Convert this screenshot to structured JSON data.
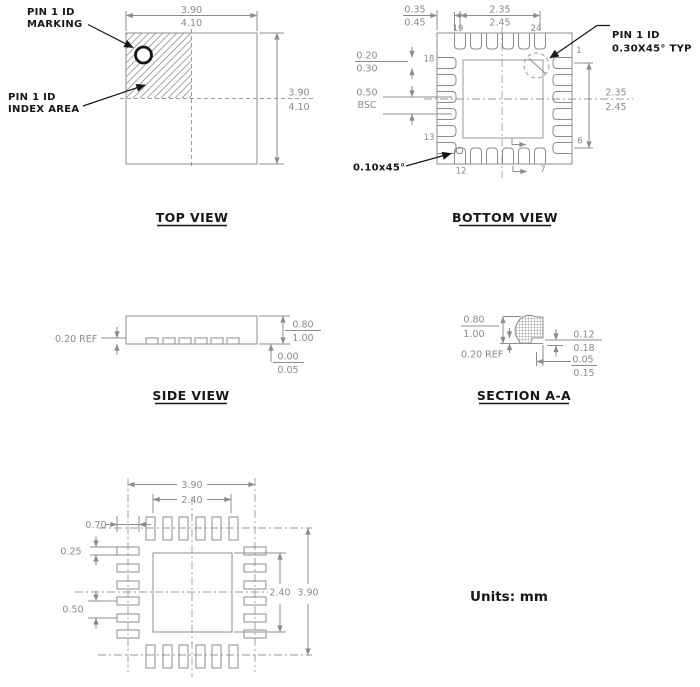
{
  "units_label": "Units: mm",
  "top_view": {
    "title": "TOP VIEW",
    "pin1_marking_label": {
      "line1": "PIN 1 ID",
      "line2": "MARKING"
    },
    "pin1_index_label": {
      "line1": "PIN 1 ID",
      "line2": "INDEX AREA"
    },
    "dim_body_width": {
      "min": "3.90",
      "max": "4.10"
    },
    "dim_body_height": {
      "min": "3.90",
      "max": "4.10"
    }
  },
  "bottom_view": {
    "title": "BOTTOM VIEW",
    "pin1_id_label": {
      "line1": "PIN 1 ID",
      "line2": "0.30X45° TYP"
    },
    "corner_chamfer_label": "0.10x45°",
    "dim_corner": {
      "min": "0.35",
      "max": "0.45"
    },
    "dim_pad_span_top": {
      "min": "2.35",
      "max": "2.45"
    },
    "dim_pad_width": {
      "min": "0.20",
      "max": "0.30"
    },
    "dim_pitch": {
      "value": "0.50",
      "note": "BSC"
    },
    "dim_pad_span_right": {
      "min": "2.35",
      "max": "2.45"
    },
    "pins": {
      "p1": "1",
      "p6": "6",
      "p7": "7",
      "p12": "12",
      "p13": "13",
      "p18": "18",
      "p19": "19",
      "p24": "24"
    }
  },
  "side_view": {
    "title": "SIDE VIEW",
    "dim_lead_thickness": "0.20 REF",
    "dim_height": {
      "min": "0.80",
      "max": "1.00"
    },
    "dim_standoff": {
      "min": "0.00",
      "max": "0.05"
    }
  },
  "section_aa": {
    "title": "SECTION A-A",
    "dim_height": {
      "min": "0.80",
      "max": "1.00"
    },
    "dim_lead_thickness": "0.20 REF",
    "dim_lead_height": {
      "min": "0.12",
      "max": "0.18"
    },
    "dim_lead_setback": {
      "min": "0.05",
      "max": "0.15"
    }
  },
  "land_pattern": {
    "dim_outer_width": "3.90",
    "dim_pad_span_top": "2.40",
    "dim_pad_length": "0.70",
    "dim_pad_width": "0.25",
    "dim_pitch": "0.50",
    "dim_center_pad": "2.40",
    "dim_outer_height": "3.90"
  }
}
